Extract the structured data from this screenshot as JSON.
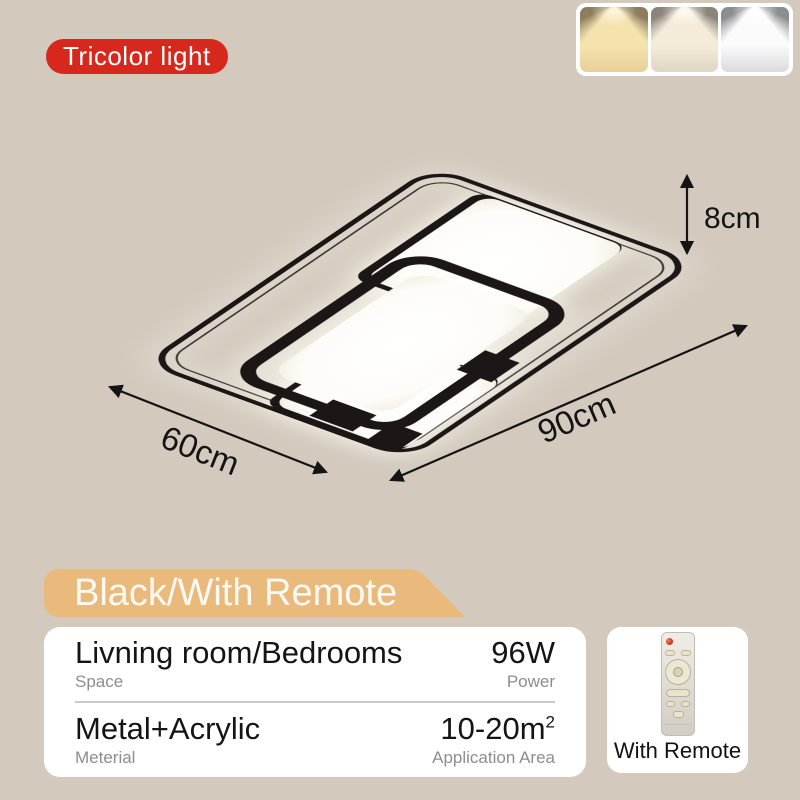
{
  "colors": {
    "background": "#d3cabd",
    "badge_red": "#d6281c",
    "banner_tan": "#eaba7c",
    "lamp_black": "#1c1712",
    "label_gray": "#8d8d8d"
  },
  "badge": {
    "label": "Tricolor light"
  },
  "light_modes": [
    {
      "name": "warm-light"
    },
    {
      "name": "neutral-light"
    },
    {
      "name": "cool-light"
    }
  ],
  "diagram": {
    "height": "8cm",
    "width": "60cm",
    "length": "90cm"
  },
  "banner": {
    "label": "Black/With Remote"
  },
  "specs": {
    "row1": {
      "value": "Livning room/Bedrooms",
      "label": "Space",
      "value_right": "96W",
      "label_right": "Power"
    },
    "row2": {
      "value": "Metal+Acrylic",
      "label": "Meterial",
      "value_right": "10-20m",
      "value_right_sup": "2",
      "label_right": "Application Area"
    }
  },
  "remote_box": {
    "label": "With Remote"
  }
}
